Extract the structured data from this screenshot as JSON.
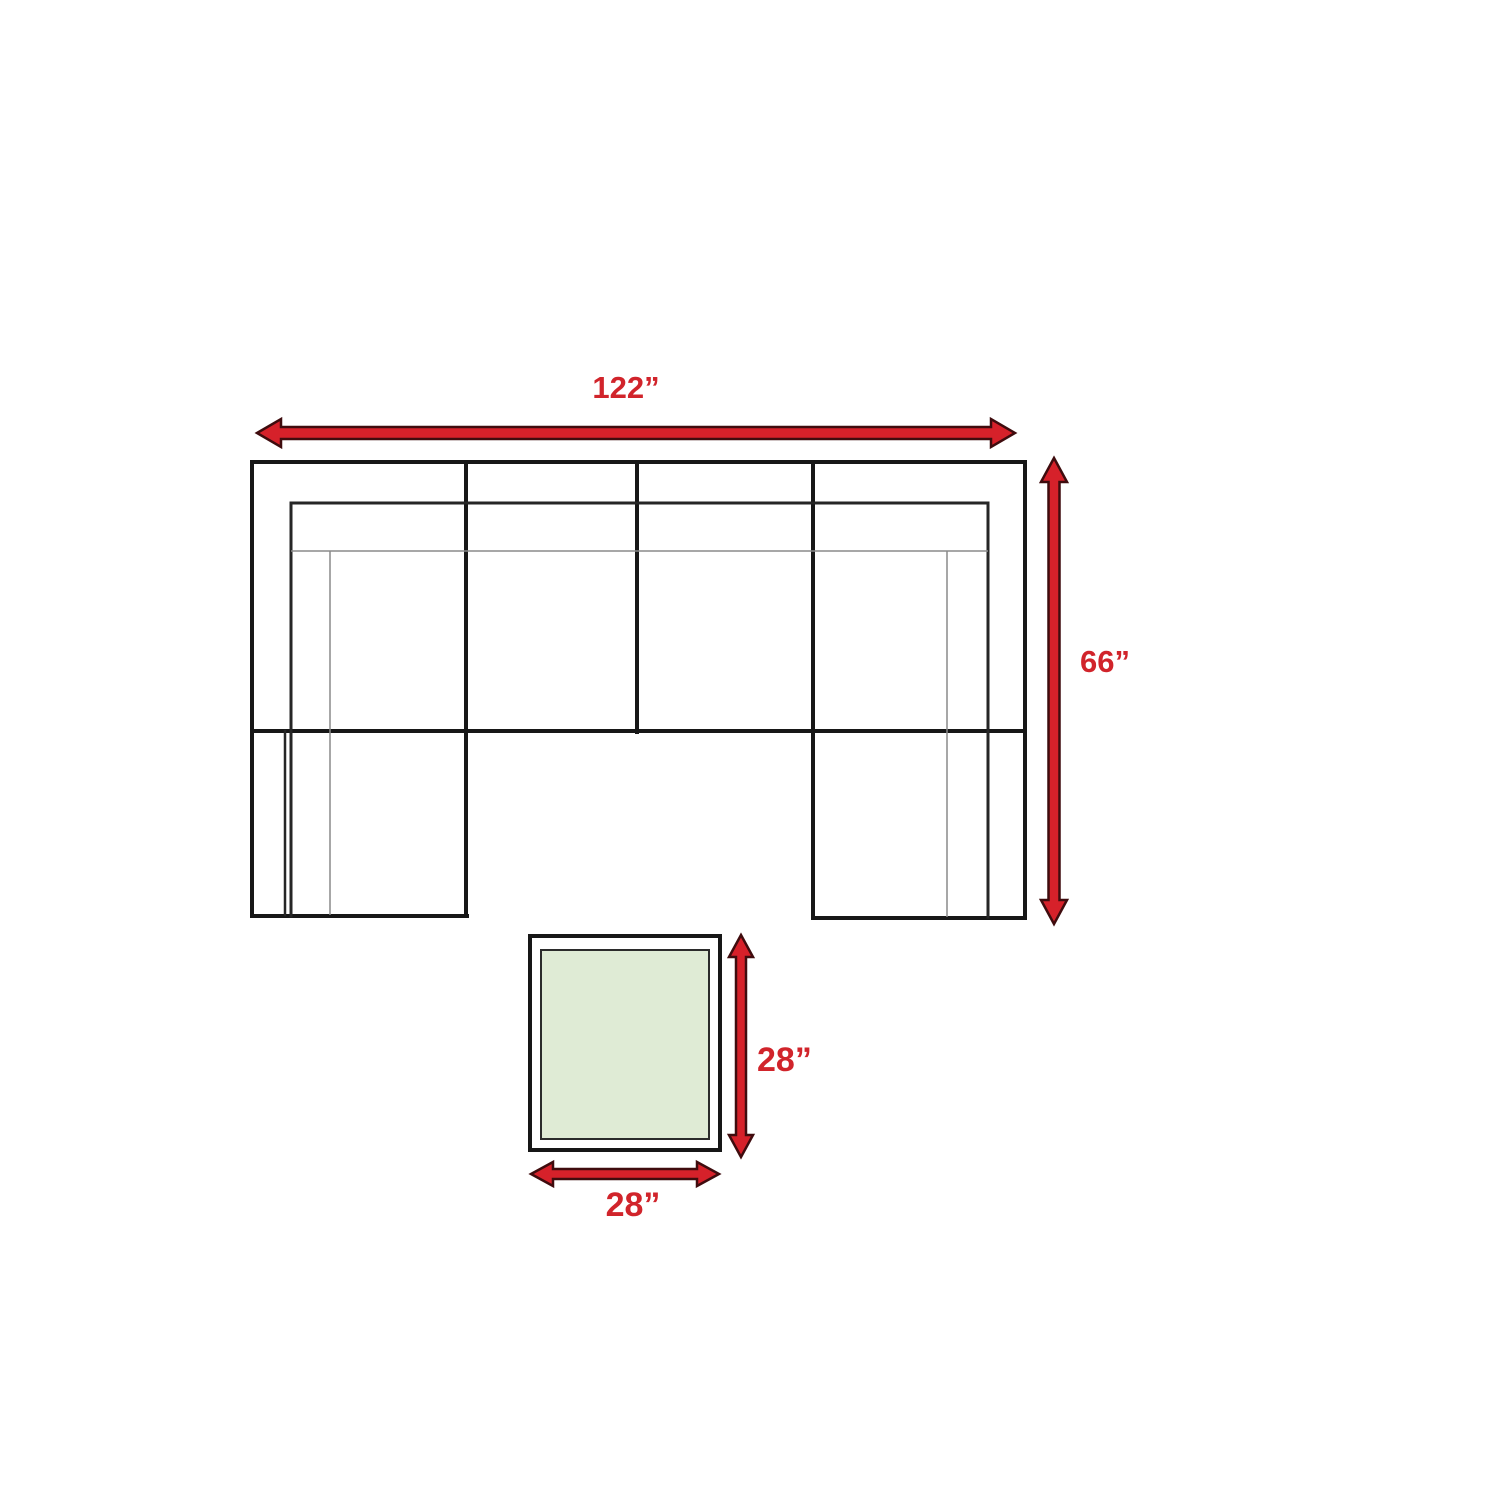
{
  "page": {
    "background": "#ffffff",
    "type_note": "top-view furniture dimension diagram"
  },
  "colors": {
    "arrow_red": "#d6212a",
    "arrow_outline": "#3f0c0e",
    "label_red": "#d1242b",
    "line_black": "#171717",
    "inner_line_black": "#262626",
    "thin_line_gray": "#8a8a8a",
    "table_surface_green": "#dfebd5",
    "table_inner_border": "#2b2b2b",
    "table_base_white": "#ffffff"
  },
  "dimensions": {
    "sofa_width": {
      "value": "122”"
    },
    "sofa_depth": {
      "value": "66”"
    },
    "table_depth": {
      "value": "28”"
    },
    "table_width": {
      "value": "28”"
    }
  }
}
